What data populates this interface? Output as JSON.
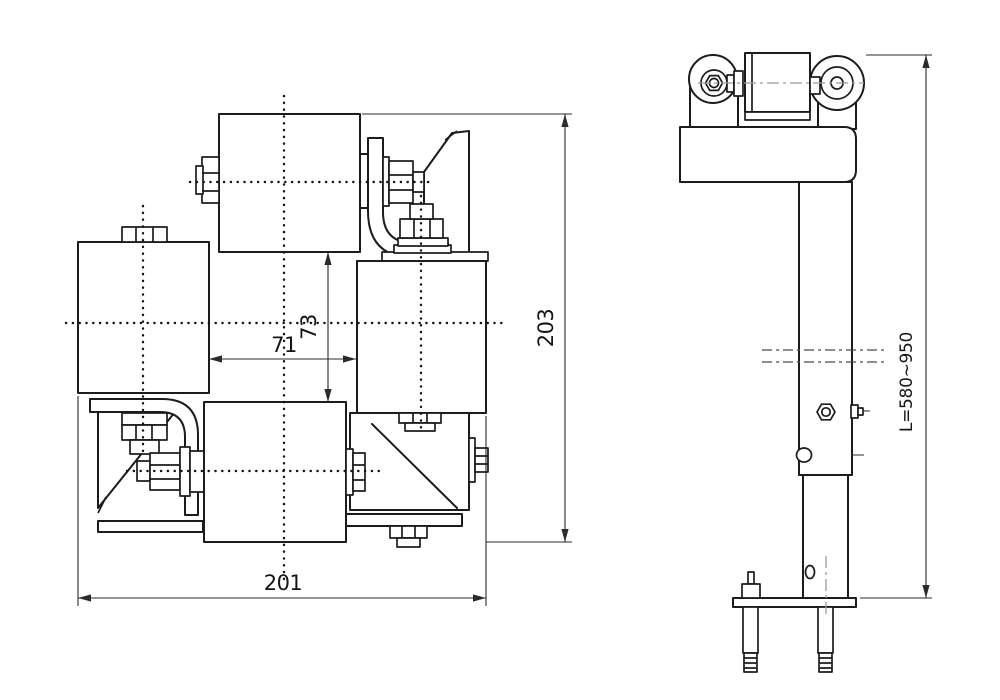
{
  "drawing": {
    "front_view": {
      "dim_inner_width": "71",
      "dim_inner_height": "73",
      "dim_overall_height": "203",
      "dim_overall_width": "201"
    },
    "side_view": {
      "dim_post_length": "L=580~950"
    }
  }
}
